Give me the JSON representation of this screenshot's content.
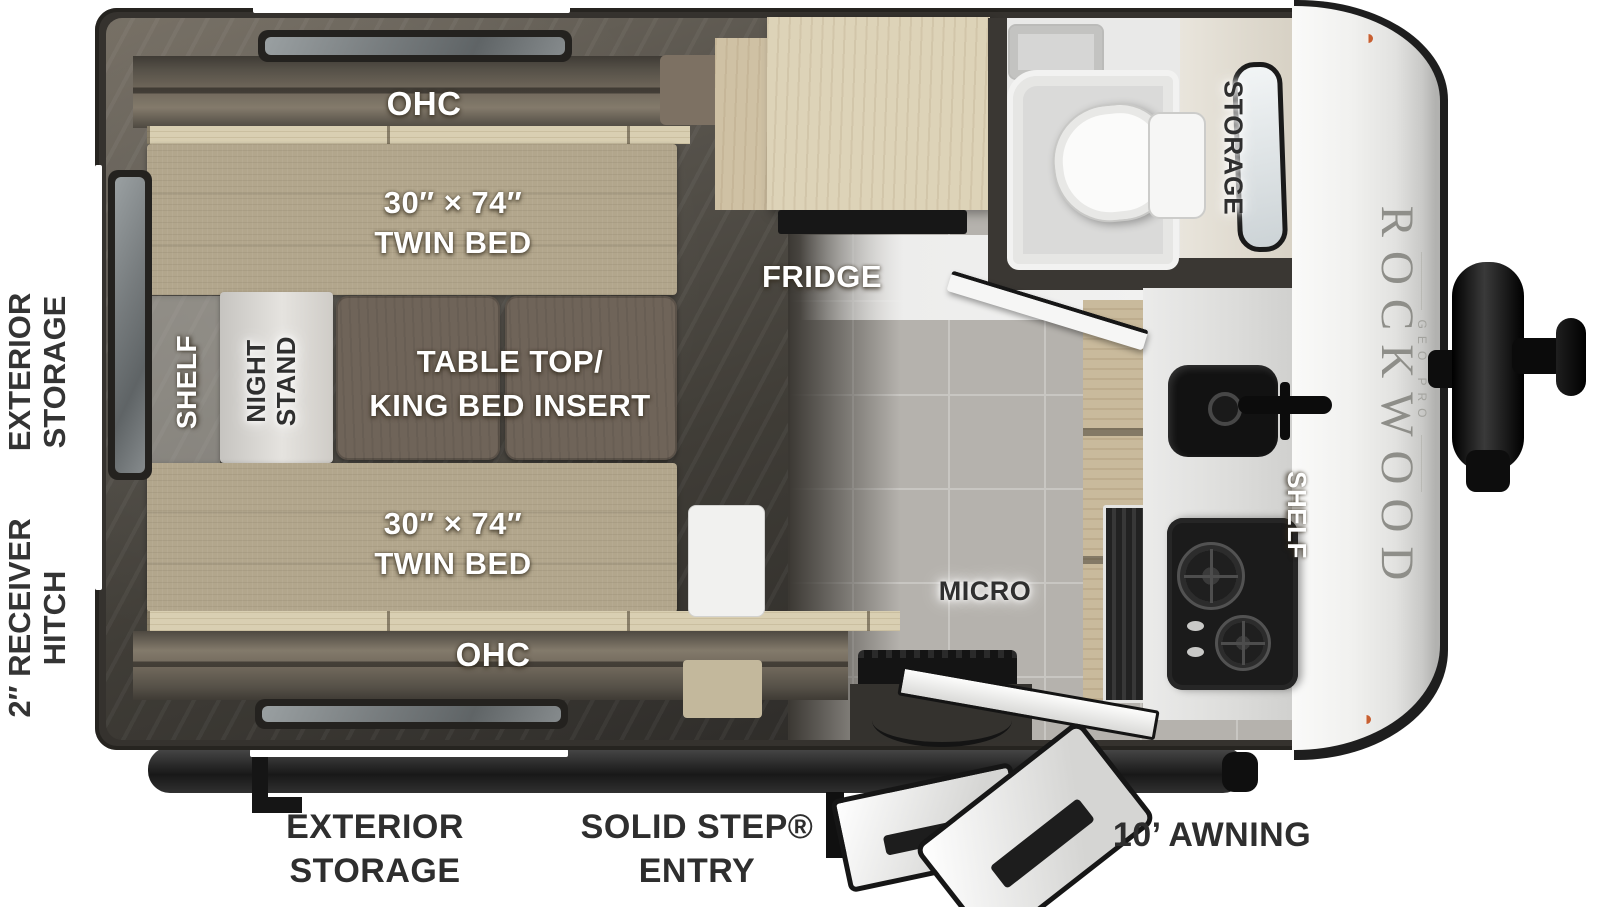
{
  "page": {
    "background": "#ffffff"
  },
  "branding": {
    "make": "ROCKWOOD",
    "series": "GEO PRO"
  },
  "colors": {
    "wall": "#3a3733",
    "bed_fabric": "#b2a68c",
    "table_wood": "#6f6459",
    "cabinet_wood": "#ddd3b8",
    "floor_dark": "#45423c",
    "floor_tile": "#b5b2ad",
    "marker_light": "#c85f31",
    "label_white": "#ffffff",
    "label_dark": "#2f2f2f"
  },
  "exterior": {
    "left_top": {
      "line1": "EXTERIOR",
      "line2": "STORAGE"
    },
    "left_bottom": {
      "line1": "2″ RECEIVER",
      "line2": "HITCH"
    },
    "bottom_storage": {
      "line1": "EXTERIOR",
      "line2": "STORAGE"
    },
    "bottom_entry": {
      "line1": "SOLID STEP®",
      "line2": "ENTRY"
    },
    "bottom_awning": "10’ AWNING"
  },
  "interior": {
    "ohc_top": "OHC",
    "ohc_bottom": "OHC",
    "bed_top": {
      "size": "30″ × 74″",
      "name": "TWIN BED"
    },
    "bed_bottom": {
      "size": "30″ × 74″",
      "name": "TWIN BED"
    },
    "table": {
      "line1": "TABLE TOP/",
      "line2": "KING BED INSERT"
    },
    "shelf_bedroom": "SHELF",
    "nightstand": {
      "line1": "NIGHT",
      "line2": "STAND"
    },
    "fridge": "FRIDGE",
    "micro": "MICRO",
    "shelf_kitchen": "SHELF",
    "storage_front": "STORAGE"
  }
}
